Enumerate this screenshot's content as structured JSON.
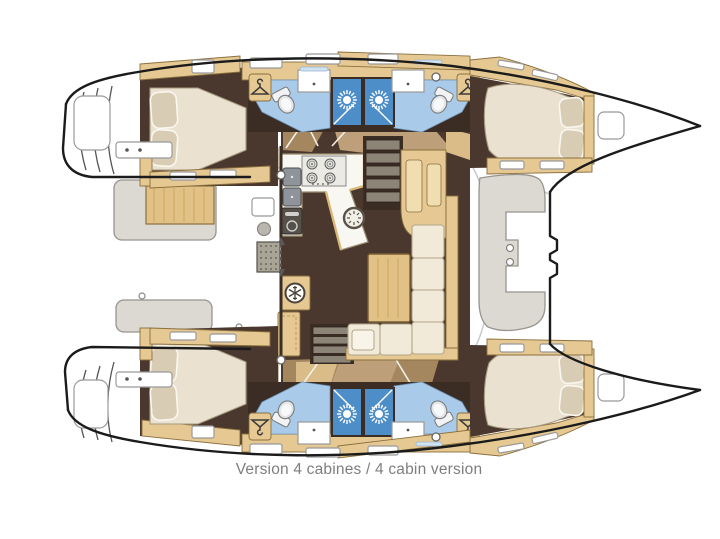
{
  "caption": {
    "text": "Version 4 cabines / 4 cabin version"
  },
  "diagram": {
    "type": "boat-floor-plan",
    "subject": "catamaran deck layout, top view, bows to the right",
    "visible_counts": {
      "double_berth_cabins": 4,
      "bathrooms": 4,
      "shower_stall_icons": 4,
      "hanger_icons": 4,
      "snowflake_icons": 2,
      "stove_burners": 4,
      "stairways": 2
    },
    "icons": {
      "shower": "white sunburst on blue square",
      "hanger": "clothes-hanger outline on tan locker",
      "snowflake": "snowflake in white circle (fridge)",
      "toilet": "oval bowl with tank",
      "stove": "2x2 burner rings",
      "door_arrow": "dashed double-headed arrow at sliding door"
    }
  },
  "palette": {
    "hull_outline": "#1b1b1b",
    "deck_line": "#c6c6c6",
    "walnut": "#4a382e",
    "walnut_wall": "#3b2c24",
    "walkway_brown": "#a5875f",
    "walkway_brown_light": "#bda07a",
    "walkway_tan": "#d9bc88",
    "cabinet_tan": "#e6c992",
    "cabinet_tan_edge": "#8a6f3f",
    "cabinet_tan_light": "#f0ddb0",
    "mattress": "#eae1d0",
    "mattress_edge": "#a79a80",
    "pillow": "#d9ccb4",
    "sofa": "#f1ead9",
    "sofa_edge": "#b3a78c",
    "bath_blue": "#a9cbe9",
    "shower_blue": "#4d8ec9",
    "bench_gray": "#dcd9d3",
    "bench_edge": "#97948e",
    "steel_dark": "#8e9499",
    "tread_gray": "#8d8478",
    "white": "#ffffff",
    "caption": "#7e7e7e"
  }
}
